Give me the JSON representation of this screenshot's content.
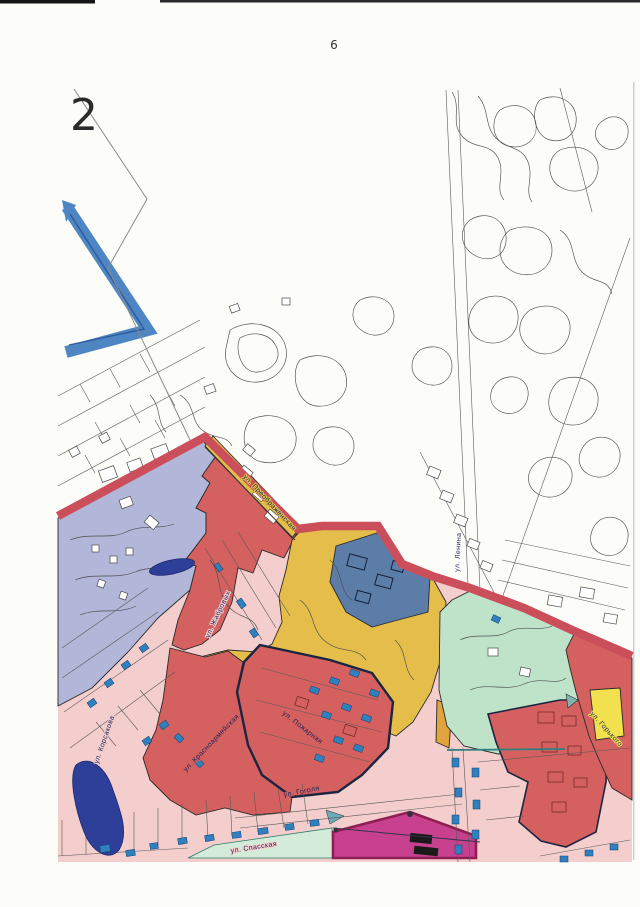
{
  "page": {
    "number": "6",
    "map_ref": "2"
  },
  "map": {
    "type": "zoning-plan-fragment",
    "streets": [
      {
        "id": "preobrazhenskaya",
        "label": "ул. Преображенская"
      },
      {
        "id": "lenina",
        "label": "ул. Ленина"
      },
      {
        "id": "zhabrovyh",
        "label": "ул. Жабровых"
      },
      {
        "id": "korsakova",
        "label": "ул. Корсакова"
      },
      {
        "id": "krasnoarmeyskaya",
        "label": "ул. Красноармейская"
      },
      {
        "id": "pozharnaya",
        "label": "ул. Пожарная"
      },
      {
        "id": "gogolya",
        "label": "ул. Гоголя"
      },
      {
        "id": "spasskaya",
        "label": "ул. Спасская"
      },
      {
        "id": "gorkogo",
        "label": "ул. Горького"
      }
    ],
    "zone_colors": {
      "pink_residential": "#f4cdcd",
      "red_residential": "#d4605f",
      "lavender_zone": "#b2b6d8",
      "yellow_road_zone": "#e4bd4a",
      "yellow_patch": "#f2e14e",
      "blue_gray_public": "#5d7da9",
      "green_space": "#bfe3c9",
      "green_strip": "#d2ecd9",
      "magenta_zone": "#c8418f",
      "boundary_red_line": "#cb4f5a",
      "water_navy": "#2e3f99",
      "highlight_blue_marker": "#4e86c4",
      "building_blue": "#2e80bf"
    }
  }
}
